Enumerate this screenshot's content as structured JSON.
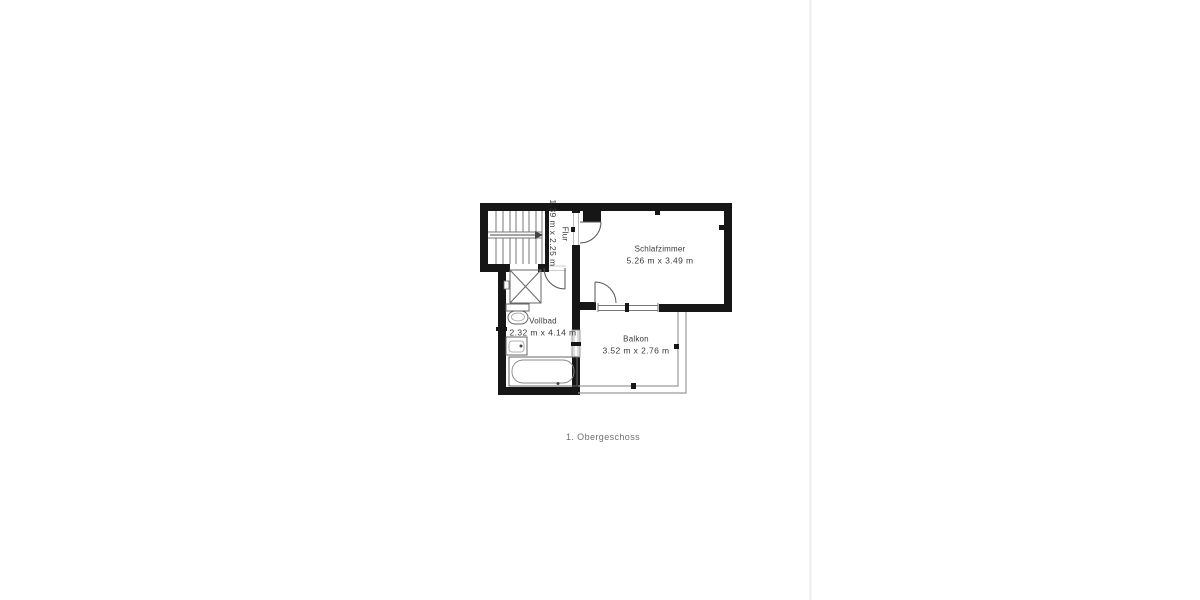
{
  "floorplan": {
    "caption": "1. Obergeschoss",
    "rooms": {
      "schlafzimmer": {
        "name": "Schlafzimmer",
        "dimensions": "5.26 m x 3.49 m"
      },
      "balkon": {
        "name": "Balkon",
        "dimensions": "3.52 m x 2.76 m"
      },
      "vollbad": {
        "name": "Vollbad",
        "dimensions": "2.32 m x 4.14 m"
      },
      "flur": {
        "name": "Flur",
        "dimensions": "1.39 m x 2.25 m"
      }
    },
    "colors": {
      "wall": "#161616",
      "fixture_line": "#666666",
      "railing_line": "#9a9a9a",
      "text": "#3a3a3a",
      "caption": "#707070",
      "page_edge": "#ececec"
    }
  }
}
